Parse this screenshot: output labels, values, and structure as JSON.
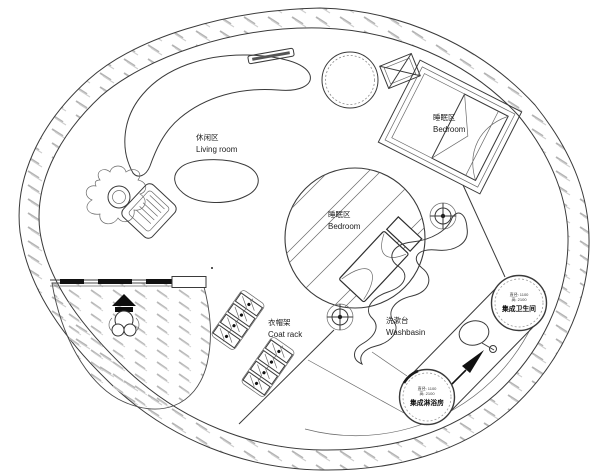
{
  "title": "圆形小屋平面布置图",
  "colors": {
    "background": "#ffffff",
    "line": "#3a3a3a",
    "hatch": "#b3b3b3",
    "door_dash": "#111111"
  },
  "areas": {
    "living_room": {
      "label_zh": "休闲区",
      "label_en": "Living room"
    },
    "bedroom_upper": {
      "label_zh": "睡眠区",
      "label_en": "Bedroom"
    },
    "bedroom_center": {
      "label_zh": "睡眠区",
      "label_en": "Bedroom"
    },
    "coat_rack": {
      "label_zh": "衣帽架",
      "label_en": "Coat rack"
    },
    "washbasin": {
      "label_zh": "洗漱台",
      "label_en": "Washbasin"
    },
    "toilet_pod": {
      "label_zh": "集成卫生间",
      "dim_diameter": "直径: 1100",
      "dim_height": "高: 2100"
    },
    "shower_pod": {
      "label_zh": "集成淋浴房",
      "dim_diameter": "直径: 1100",
      "dim_height": "高: 2100"
    }
  },
  "icons": {
    "sofa": "curved-sofa-icon",
    "coffee_table": "kidney-table-icon",
    "plant": "potted-plant-icon",
    "armchair": "armchair-icon",
    "round_table": "round-table-icon",
    "vent": "crossed-box-vent-icon",
    "wall_shelf": "wall-shelf-icon",
    "bed": "bed-icon",
    "downlight": "crosshair-target-icon",
    "mirror": "hand-mirror-icon",
    "arrow": "direction-arrow-icon",
    "statue": "statue-icon",
    "coat_rack": "coat-rack-icon",
    "sliding_door": "sliding-door-icon"
  }
}
